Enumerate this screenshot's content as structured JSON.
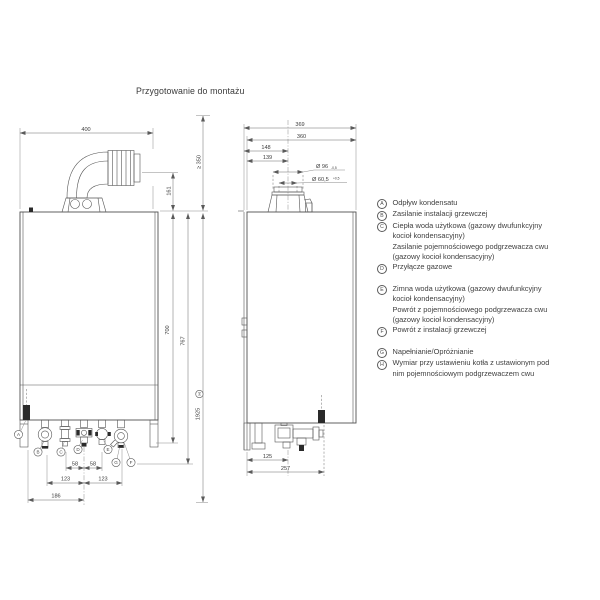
{
  "page": {
    "title": "Przygotowanie do montażu",
    "background_color": "#ffffff",
    "line_color": "#4f4f4f",
    "dimension_line_color": "#696969",
    "text_color": "#3d3d3d"
  },
  "front_view": {
    "dims": {
      "width": "400",
      "flue_height": "161",
      "top_clearance": "≥ 350",
      "height_to_connections": "700",
      "height_total": "767",
      "height_with_storage": "1925",
      "height_with_storage_ref": "H",
      "spacing_c_d": "58",
      "spacing_d_e": "58",
      "spacing_b_d": "123",
      "spacing_d_fg": "123",
      "spacing_a_d": "186"
    },
    "callouts": [
      "A",
      "B",
      "C",
      "D",
      "E",
      "G",
      "F"
    ]
  },
  "side_view": {
    "dims": {
      "depth_total": "369",
      "depth_body": "360",
      "flue_axis_from_back_outer": "148",
      "flue_axis_from_back": "139",
      "flue_outer_dia": "Ø 96",
      "flue_outer_tol": "-0,5",
      "flue_inner_dia": "Ø 60,5",
      "flue_inner_tol": "+0,5",
      "gas_axis_depth": "125",
      "siphon_axis_depth": "257"
    }
  },
  "legend": {
    "items": [
      {
        "letter": "A",
        "lines": [
          "Odpływ kondensatu"
        ]
      },
      {
        "letter": "B",
        "lines": [
          "Zasilanie instalacji grzewczej"
        ]
      },
      {
        "letter": "C",
        "lines": [
          "Ciepła woda użytkowa (gazowy dwufunkcyjny",
          "kocioł kondensacyjny)",
          "Zasilanie pojemnościowego podgrzewacza cwu",
          "(gazowy kocioł kondensacyjny)"
        ]
      },
      {
        "letter": "D",
        "lines": [
          "Przyłącze gazowe"
        ]
      },
      {
        "letter": "E",
        "lines": [
          "Zimna woda użytkowa (gazowy dwufunkcyjny",
          "kocioł kondensacyjny)",
          "Powrót z pojemnościowego podgrzewacza cwu",
          "(gazowy kocioł kondensacyjny)"
        ]
      },
      {
        "letter": "F",
        "lines": [
          "Powrót z instalacji grzewczej"
        ]
      },
      {
        "letter": "G",
        "lines": [
          "Napełnianie/Opróżnianie"
        ]
      },
      {
        "letter": "H",
        "lines": [
          "Wymiar przy ustawieniu kotła z ustawionym pod",
          "nim pojemnościowym podgrzewaczem cwu"
        ]
      }
    ]
  }
}
